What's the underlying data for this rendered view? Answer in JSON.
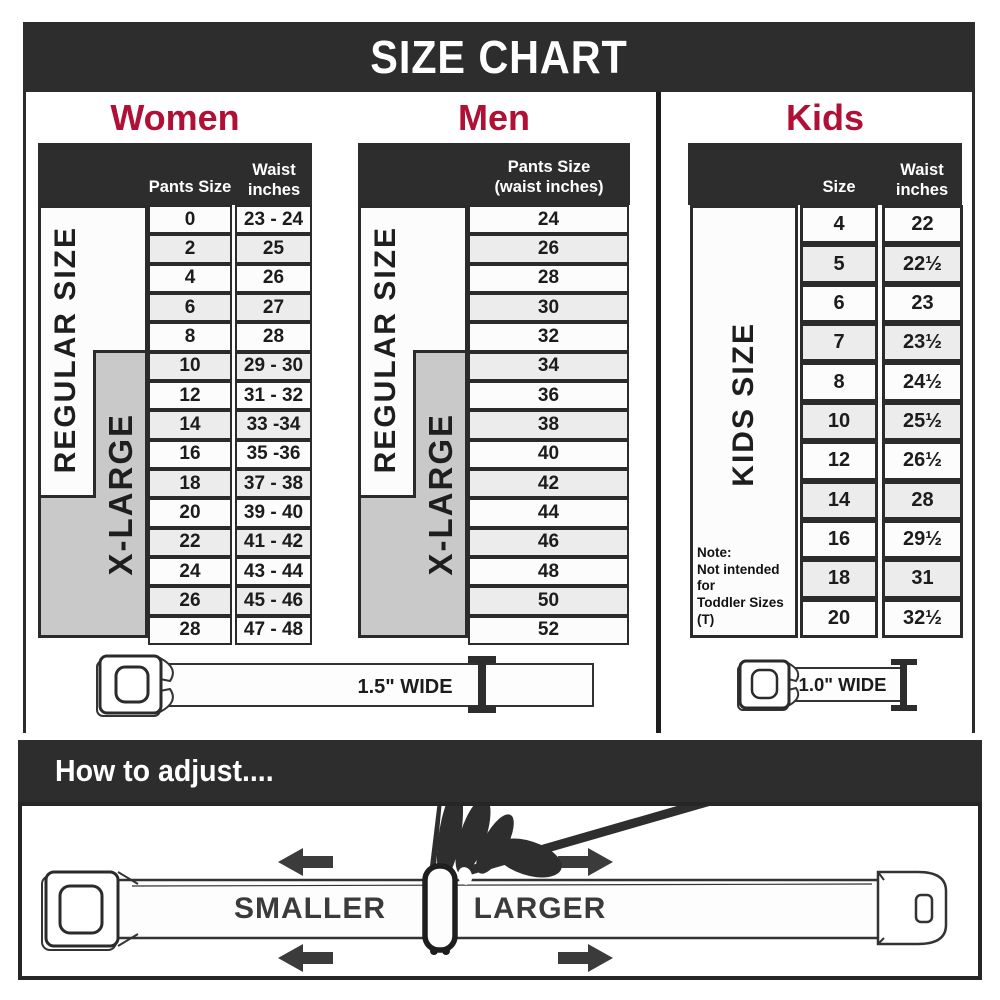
{
  "title": "SIZE CHART",
  "colors": {
    "accent": "#b01035",
    "dark": "#2d2d2d",
    "panel_gray": "#c9c9c9",
    "row_alt": "#ececec"
  },
  "sections": {
    "women": {
      "title": "Women",
      "col1_header": "Pants Size",
      "col2_header_line1": "Waist",
      "col2_header_line2": "inches",
      "regular_label": "REGULAR SIZE",
      "xlarge_label": "X-LARGE",
      "rows": [
        {
          "size": "0",
          "waist": "23 - 24"
        },
        {
          "size": "2",
          "waist": "25"
        },
        {
          "size": "4",
          "waist": "26"
        },
        {
          "size": "6",
          "waist": "27"
        },
        {
          "size": "8",
          "waist": "28"
        },
        {
          "size": "10",
          "waist": "29 - 30"
        },
        {
          "size": "12",
          "waist": "31 - 32"
        },
        {
          "size": "14",
          "waist": "33 -34"
        },
        {
          "size": "16",
          "waist": "35 -36"
        },
        {
          "size": "18",
          "waist": "37 - 38"
        },
        {
          "size": "20",
          "waist": "39 - 40"
        },
        {
          "size": "22",
          "waist": "41 - 42"
        },
        {
          "size": "24",
          "waist": "43 - 44"
        },
        {
          "size": "26",
          "waist": "45 - 46"
        },
        {
          "size": "28",
          "waist": "47 - 48"
        }
      ]
    },
    "men": {
      "title": "Men",
      "col_header_line1": "Pants Size",
      "col_header_line2": "(waist inches)",
      "regular_label": "REGULAR SIZE",
      "xlarge_label": "X-LARGE",
      "rows": [
        "24",
        "26",
        "28",
        "30",
        "32",
        "34",
        "36",
        "38",
        "40",
        "42",
        "44",
        "46",
        "48",
        "50",
        "52"
      ]
    },
    "kids": {
      "title": "Kids",
      "col1_header": "Size",
      "col2_header_line1": "Waist",
      "col2_header_line2": "inches",
      "panel_label": "KIDS SIZE",
      "note_line1": "Note:",
      "note_line2": "Not intended for",
      "note_line3": "Toddler Sizes (T)",
      "rows": [
        {
          "size": "4",
          "waist": "22"
        },
        {
          "size": "5",
          "waist": "22½"
        },
        {
          "size": "6",
          "waist": "23"
        },
        {
          "size": "7",
          "waist": "23½"
        },
        {
          "size": "8",
          "waist": "24½"
        },
        {
          "size": "10",
          "waist": "25½"
        },
        {
          "size": "12",
          "waist": "26½"
        },
        {
          "size": "14",
          "waist": "28"
        },
        {
          "size": "16",
          "waist": "29½"
        },
        {
          "size": "18",
          "waist": "31"
        },
        {
          "size": "20",
          "waist": "32½"
        }
      ]
    }
  },
  "belts": {
    "adult_width_label": "1.5\" WIDE",
    "kids_width_label": "1.0\" WIDE"
  },
  "how_to_adjust": {
    "heading": "How to adjust....",
    "smaller_label": "SMALLER",
    "larger_label": "LARGER"
  },
  "chart_data": [
    {
      "type": "table",
      "title": "Women",
      "columns": [
        "Pants Size",
        "Waist inches"
      ],
      "rows": [
        [
          "0",
          "23 - 24"
        ],
        [
          "2",
          "25"
        ],
        [
          "4",
          "26"
        ],
        [
          "6",
          "27"
        ],
        [
          "8",
          "28"
        ],
        [
          "10",
          "29 - 30"
        ],
        [
          "12",
          "31 - 32"
        ],
        [
          "14",
          "33 -34"
        ],
        [
          "16",
          "35 -36"
        ],
        [
          "18",
          "37 - 38"
        ],
        [
          "20",
          "39 - 40"
        ],
        [
          "22",
          "41 - 42"
        ],
        [
          "24",
          "43 - 44"
        ],
        [
          "26",
          "45 - 46"
        ],
        [
          "28",
          "47 - 48"
        ]
      ],
      "annotations": [
        "REGULAR SIZE: pants sizes 0-8",
        "X-LARGE: pants sizes 10-28",
        "Belt width 1.5\" WIDE"
      ]
    },
    {
      "type": "table",
      "title": "Men",
      "columns": [
        "Pants Size (waist inches)"
      ],
      "rows": [
        [
          "24"
        ],
        [
          "26"
        ],
        [
          "28"
        ],
        [
          "30"
        ],
        [
          "32"
        ],
        [
          "34"
        ],
        [
          "36"
        ],
        [
          "38"
        ],
        [
          "40"
        ],
        [
          "42"
        ],
        [
          "44"
        ],
        [
          "46"
        ],
        [
          "48"
        ],
        [
          "50"
        ],
        [
          "52"
        ]
      ],
      "annotations": [
        "REGULAR SIZE: sizes 24-32",
        "X-LARGE: sizes 34-52",
        "Belt width 1.5\" WIDE"
      ]
    },
    {
      "type": "table",
      "title": "Kids",
      "columns": [
        "Size",
        "Waist inches"
      ],
      "rows": [
        [
          "4",
          "22"
        ],
        [
          "5",
          "22½"
        ],
        [
          "6",
          "23"
        ],
        [
          "7",
          "23½"
        ],
        [
          "8",
          "24½"
        ],
        [
          "10",
          "25½"
        ],
        [
          "12",
          "26½"
        ],
        [
          "14",
          "28"
        ],
        [
          "16",
          "29½"
        ],
        [
          "18",
          "31"
        ],
        [
          "20",
          "32½"
        ]
      ],
      "annotations": [
        "KIDS SIZE",
        "Note: Not intended for Toddler Sizes (T)",
        "Belt width 1.0\" WIDE"
      ]
    }
  ]
}
